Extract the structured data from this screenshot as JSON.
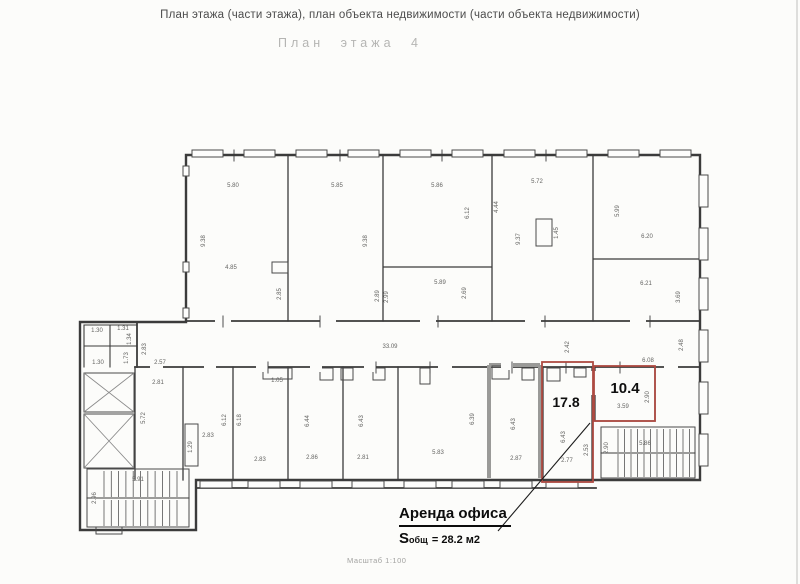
{
  "header": {
    "title": "План этажа (части этажа), план объекта недвижимости (части объекта недвижимости)",
    "subtitle": "План этажа 4"
  },
  "footer": {
    "scale": "Масштаб 1:100"
  },
  "annotation": {
    "title": "Аренда офиса",
    "area_prefix": "S",
    "area_sub": "общ",
    "area_value": "= 28.2 м2"
  },
  "areas": {
    "room1": "17.8",
    "room2": "10.4"
  },
  "colors": {
    "highlight": "#ad4a42",
    "line": "#3b3b3b"
  },
  "plan_labels": [
    {
      "t": "5.80",
      "x": 233,
      "y": 187
    },
    {
      "t": "9.38",
      "x": 205,
      "y": 241,
      "r": 1
    },
    {
      "t": "4.85",
      "x": 231,
      "y": 269
    },
    {
      "t": "2.85",
      "x": 281,
      "y": 294,
      "r": 1
    },
    {
      "t": "5.85",
      "x": 337,
      "y": 187
    },
    {
      "t": "9.38",
      "x": 367,
      "y": 241,
      "r": 1
    },
    {
      "t": "2.89",
      "x": 379,
      "y": 296,
      "r": 1
    },
    {
      "t": "5.86",
      "x": 437,
      "y": 187
    },
    {
      "t": "6.12",
      "x": 469,
      "y": 213,
      "r": 1
    },
    {
      "t": "4.44",
      "x": 498,
      "y": 207,
      "r": 1
    },
    {
      "t": "5.72",
      "x": 537,
      "y": 183
    },
    {
      "t": "9.37",
      "x": 520,
      "y": 239,
      "r": 1
    },
    {
      "t": "1.45",
      "x": 558,
      "y": 233,
      "r": 1
    },
    {
      "t": "5.99",
      "x": 619,
      "y": 211,
      "r": 1
    },
    {
      "t": "6.20",
      "x": 647,
      "y": 238
    },
    {
      "t": "5.89",
      "x": 440,
      "y": 284
    },
    {
      "t": "2.99",
      "x": 388,
      "y": 297,
      "r": 1
    },
    {
      "t": "2.69",
      "x": 466,
      "y": 293,
      "r": 1
    },
    {
      "t": "6.21",
      "x": 646,
      "y": 285
    },
    {
      "t": "3.69",
      "x": 680,
      "y": 297,
      "r": 1
    },
    {
      "t": "33.09",
      "x": 390,
      "y": 348
    },
    {
      "t": "2.42",
      "x": 569,
      "y": 347,
      "r": 1
    },
    {
      "t": "2.48",
      "x": 683,
      "y": 345,
      "r": 1
    },
    {
      "t": "6.08",
      "x": 648,
      "y": 362
    },
    {
      "t": "1.30",
      "x": 97,
      "y": 332
    },
    {
      "t": "1.31",
      "x": 123,
      "y": 330
    },
    {
      "t": "1.34",
      "x": 131,
      "y": 339,
      "r": 1
    },
    {
      "t": "1.73",
      "x": 128,
      "y": 358,
      "r": 1
    },
    {
      "t": "1.30",
      "x": 98,
      "y": 364
    },
    {
      "t": "2.83",
      "x": 146,
      "y": 349,
      "r": 1
    },
    {
      "t": "2.57",
      "x": 160,
      "y": 364
    },
    {
      "t": "2.81",
      "x": 158,
      "y": 384
    },
    {
      "t": "5.72",
      "x": 145,
      "y": 418,
      "r": 1
    },
    {
      "t": "2.83",
      "x": 208,
      "y": 437
    },
    {
      "t": "6.12",
      "x": 226,
      "y": 420,
      "r": 1
    },
    {
      "t": "1.29",
      "x": 192,
      "y": 447,
      "r": 1
    },
    {
      "t": "2.83",
      "x": 260,
      "y": 461
    },
    {
      "t": "6.18",
      "x": 241,
      "y": 420,
      "r": 1
    },
    {
      "t": "1.05",
      "x": 277,
      "y": 382
    },
    {
      "t": "2.86",
      "x": 312,
      "y": 459
    },
    {
      "t": "6.44",
      "x": 309,
      "y": 421,
      "r": 1
    },
    {
      "t": "2.81",
      "x": 363,
      "y": 459
    },
    {
      "t": "6.43",
      "x": 363,
      "y": 421,
      "r": 1
    },
    {
      "t": "5.83",
      "x": 438,
      "y": 454
    },
    {
      "t": "6.39",
      "x": 474,
      "y": 419,
      "r": 1
    },
    {
      "t": "2.87",
      "x": 516,
      "y": 460
    },
    {
      "t": "6.43",
      "x": 515,
      "y": 424,
      "r": 1
    },
    {
      "t": "2.77",
      "x": 567,
      "y": 462
    },
    {
      "t": "6.43",
      "x": 565,
      "y": 437,
      "r": 1
    },
    {
      "t": "2.53",
      "x": 588,
      "y": 450,
      "r": 1
    },
    {
      "t": "3.59",
      "x": 623,
      "y": 408
    },
    {
      "t": "2.90",
      "x": 649,
      "y": 397,
      "r": 1
    },
    {
      "t": "2.90",
      "x": 608,
      "y": 448,
      "r": 1
    },
    {
      "t": "5.86",
      "x": 645,
      "y": 445
    },
    {
      "t": "5.91",
      "x": 138,
      "y": 481
    },
    {
      "t": "2.96",
      "x": 96,
      "y": 498,
      "r": 1
    }
  ]
}
